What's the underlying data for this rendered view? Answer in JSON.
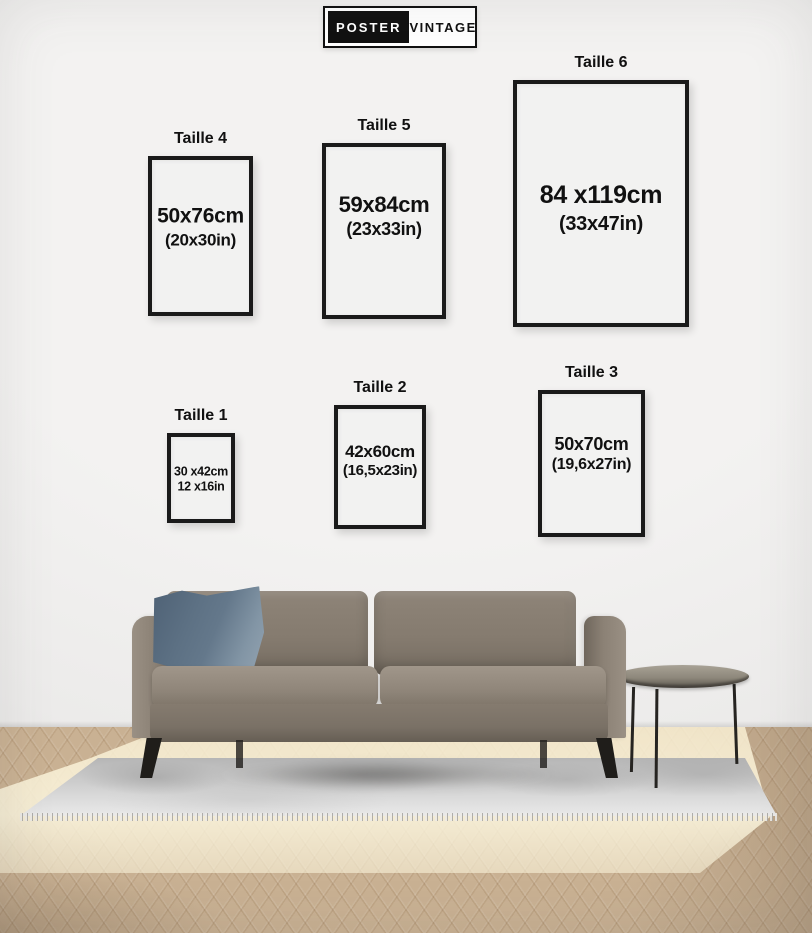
{
  "brand": {
    "poster": "POSTER",
    "vintage": "VINTAGE"
  },
  "size_guide": {
    "sizes": [
      {
        "id": "taille-4",
        "label": "Taille 4",
        "cm": "50x76cm",
        "inches": "(20x30in)"
      },
      {
        "id": "taille-5",
        "label": "Taille 5",
        "cm": "59x84cm",
        "inches": "(23x33in)"
      },
      {
        "id": "taille-6",
        "label": "Taille 6",
        "cm": "84 x119cm",
        "inches": "(33x47in)"
      },
      {
        "id": "taille-1",
        "label": "Taille 1",
        "cm": "30 x42cm",
        "inches": "12 x16in"
      },
      {
        "id": "taille-2",
        "label": "Taille 2",
        "cm": "42x60cm",
        "inches": "(16,5x23in)"
      },
      {
        "id": "taille-3",
        "label": "Taille 3",
        "cm": "50x70cm",
        "inches": "(19,6x27in)"
      }
    ]
  },
  "colors": {
    "wall": "#f0efee",
    "text": "#111111",
    "frame_border": "#1a1a1a",
    "logo_black": "#111111",
    "logo_white": "#ffffff",
    "sofa": "#8a8076",
    "pillow": "#64788b",
    "rug": "#dcdcdc",
    "floor_wood": "#c9b193",
    "floor_sunlit": "#f5ebcd"
  }
}
